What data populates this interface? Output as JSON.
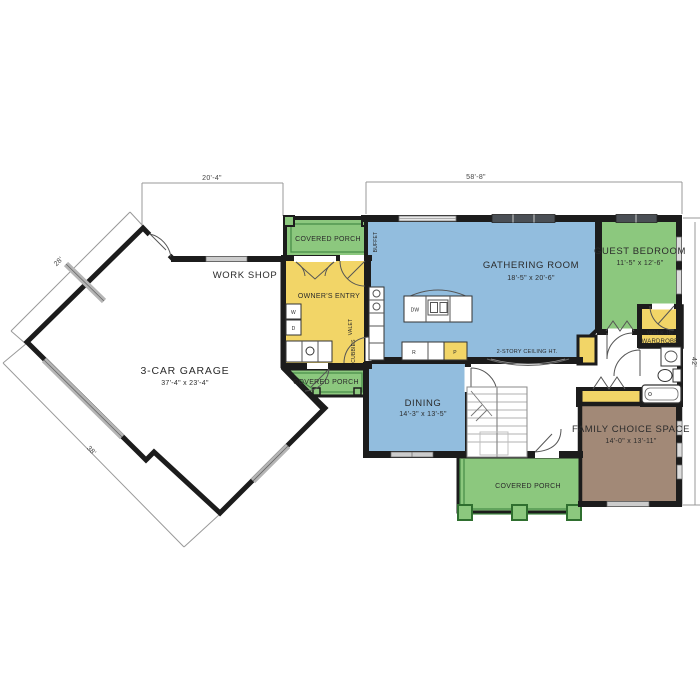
{
  "plan": {
    "rooms": {
      "garage": {
        "name": "3-CAR GARAGE",
        "dims": "37'-4\" x 23'-4\""
      },
      "workshop": {
        "name": "WORK SHOP"
      },
      "covered_porch_top": {
        "name": "COVERED PORCH"
      },
      "owners_entry": {
        "name": "OWNER'S ENTRY"
      },
      "covered_porch_mid": {
        "name": "COVERED PORCH"
      },
      "gathering_room": {
        "name": "GATHERING ROOM",
        "dims": "18'-5\" x 20'-6\"",
        "note": "2-STORY CEILING HT."
      },
      "guest_bedroom": {
        "name": "GUEST BEDROOM",
        "dims": "11'-5\" x 12'-6\""
      },
      "walk_in_wardrobe": {
        "line1": "WALK-IN",
        "line2": "WARDROBE"
      },
      "dining": {
        "name": "DINING",
        "dims": "14'-3\" x 13'-5\""
      },
      "family_choice": {
        "name": "FAMILY CHOICE SPACE",
        "dims": "14'-0\" x 13'-11\""
      },
      "covered_porch_bottom": {
        "name": "COVERED PORCH"
      }
    },
    "fixtures": {
      "washer": "W",
      "dryer": "D",
      "dishwasher": "DW",
      "range": "R",
      "pantry": "P",
      "valet": "VALET",
      "cubbies": "CUBBIES",
      "buffet": "BUFFET"
    },
    "dimensions": {
      "top_left": "20'-4\"",
      "top_right": "58'-8\"",
      "right": "42'",
      "upper_left": "28'",
      "lower_left": "38'"
    },
    "colors": {
      "room_blue": "#92bdde",
      "room_green": "#8cc87e",
      "room_yellow": "#f2d567",
      "room_brown": "#a28977",
      "wall": "#1c1c1c",
      "dimension": "#999999"
    }
  }
}
